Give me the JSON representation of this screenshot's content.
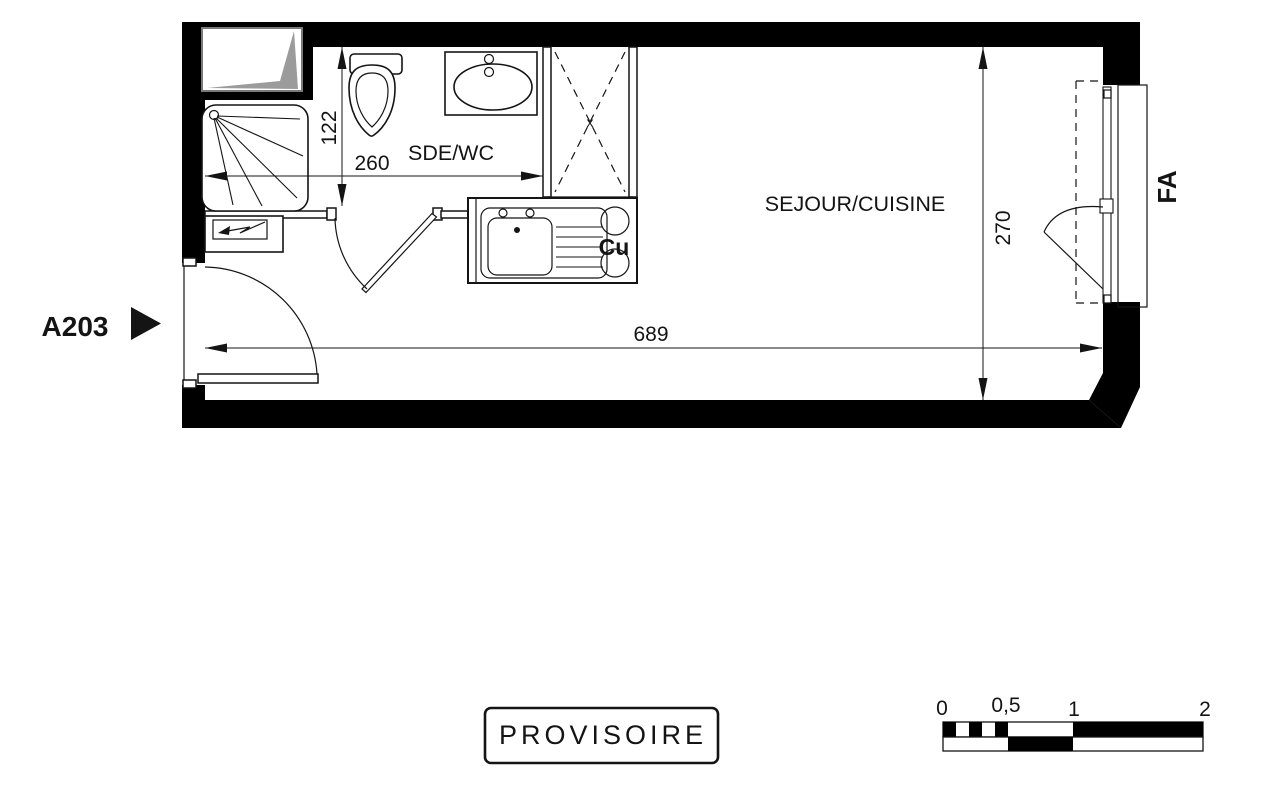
{
  "unit": {
    "label": "A203"
  },
  "rooms": {
    "bathroom_label": "SDE/WC",
    "living_label": "SEJOUR/CUISINE",
    "kitchen_label": "Cu",
    "closet_mark": "x",
    "window_label": "FA"
  },
  "dimensions_cm": {
    "bathroom_depth": "122",
    "bathroom_width": "260",
    "living_width": "689",
    "living_depth": "270"
  },
  "stamp": {
    "text": "PROVISOIRE"
  },
  "scale_bar": {
    "tick_labels": [
      "0",
      "0,5",
      "1",
      "2"
    ]
  },
  "colors": {
    "ink": "#141414",
    "wall_fill": "#000000",
    "duct_gray": "#9b9b9b",
    "paper": "#ffffff"
  }
}
